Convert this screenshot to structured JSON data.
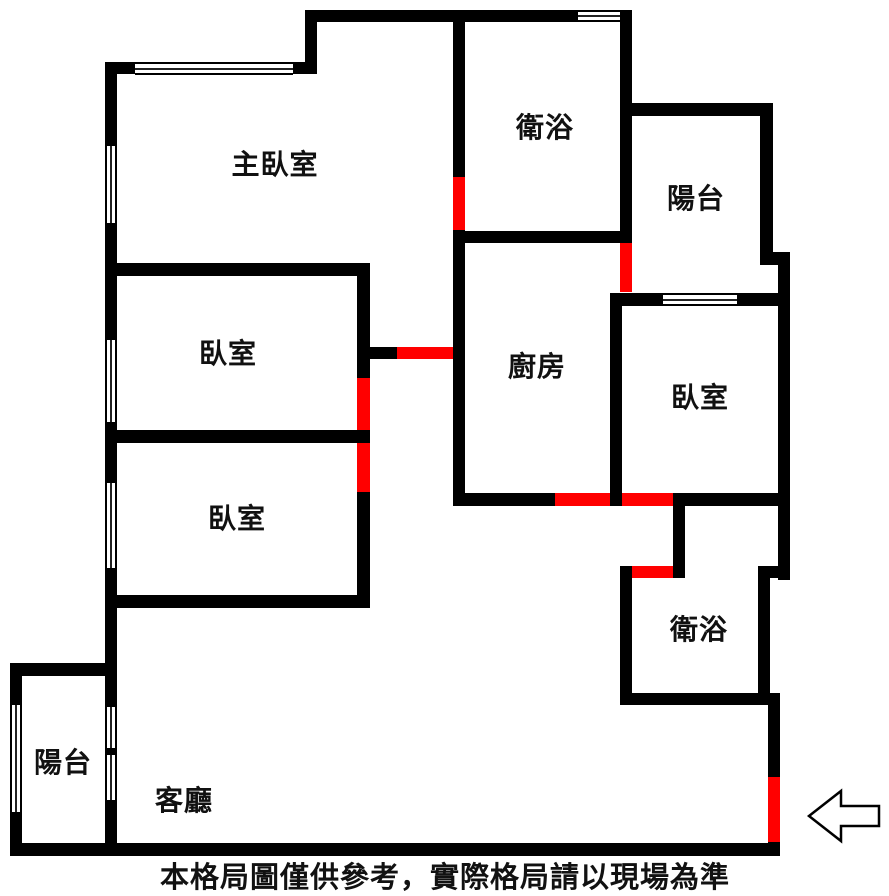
{
  "caption": "本格局圖僅供參考，實際格局請以現場為準",
  "colors": {
    "wall": "#000000",
    "door": "#ff0000",
    "background": "#ffffff",
    "window_line": "#222222"
  },
  "plan": {
    "labels": [
      {
        "name": "master-bedroom",
        "text": "主臥室",
        "x": 275,
        "y": 163
      },
      {
        "name": "bathroom-top",
        "text": "衛浴",
        "x": 545,
        "y": 126
      },
      {
        "name": "balcony-top",
        "text": "陽台",
        "x": 696,
        "y": 197
      },
      {
        "name": "bedroom-left-1",
        "text": "臥室",
        "x": 228,
        "y": 352
      },
      {
        "name": "kitchen",
        "text": "廚房",
        "x": 537,
        "y": 365
      },
      {
        "name": "bedroom-right",
        "text": "臥室",
        "x": 700,
        "y": 396
      },
      {
        "name": "bedroom-left-2",
        "text": "臥室",
        "x": 237,
        "y": 517
      },
      {
        "name": "bathroom-bottom",
        "text": "衛浴",
        "x": 699,
        "y": 628
      },
      {
        "name": "balcony-bottom",
        "text": "陽台",
        "x": 63,
        "y": 761
      },
      {
        "name": "living-room",
        "text": "客廳",
        "x": 184,
        "y": 799
      }
    ],
    "walls": [
      [
        105,
        62,
        212,
        12
      ],
      [
        305,
        10,
        327,
        12
      ],
      [
        305,
        10,
        12,
        64
      ],
      [
        105,
        62,
        12,
        781
      ],
      [
        105,
        263,
        265,
        13
      ],
      [
        105,
        430,
        265,
        13
      ],
      [
        357,
        263,
        13,
        345
      ],
      [
        105,
        595,
        265,
        13
      ],
      [
        357,
        347,
        40,
        12
      ],
      [
        453,
        10,
        12,
        493
      ],
      [
        465,
        231,
        167,
        12
      ],
      [
        620,
        10,
        12,
        233
      ],
      [
        620,
        103,
        153,
        13
      ],
      [
        760,
        103,
        13,
        162
      ],
      [
        760,
        252,
        30,
        13
      ],
      [
        778,
        252,
        12,
        328
      ],
      [
        610,
        293,
        180,
        13
      ],
      [
        610,
        293,
        12,
        213
      ],
      [
        453,
        493,
        337,
        13
      ],
      [
        673,
        493,
        12,
        85
      ],
      [
        620,
        566,
        65,
        12
      ],
      [
        620,
        566,
        12,
        139
      ],
      [
        758,
        566,
        12,
        139
      ],
      [
        758,
        566,
        32,
        12
      ],
      [
        620,
        693,
        150,
        12
      ],
      [
        768,
        693,
        12,
        150
      ],
      [
        10,
        843,
        770,
        13
      ],
      [
        10,
        663,
        12,
        180
      ],
      [
        10,
        663,
        107,
        13
      ]
    ],
    "windows": [
      [
        135,
        62,
        158,
        13
      ],
      [
        578,
        10,
        42,
        12
      ],
      [
        105,
        146,
        12,
        77
      ],
      [
        105,
        340,
        12,
        82
      ],
      [
        105,
        483,
        12,
        85
      ],
      [
        663,
        293,
        74,
        13
      ],
      [
        10,
        705,
        12,
        107
      ],
      [
        105,
        707,
        12,
        41
      ],
      [
        105,
        755,
        12,
        45
      ]
    ],
    "doors": [
      [
        453,
        177,
        12,
        53
      ],
      [
        397,
        347,
        56,
        12
      ],
      [
        357,
        378,
        13,
        52
      ],
      [
        357,
        443,
        13,
        49
      ],
      [
        620,
        243,
        12,
        49
      ],
      [
        555,
        493,
        55,
        13
      ],
      [
        622,
        493,
        51,
        13
      ],
      [
        632,
        566,
        41,
        12
      ],
      [
        768,
        777,
        12,
        65
      ]
    ]
  },
  "entrance": {
    "icon": "left-arrow",
    "meaning": "entrance direction"
  }
}
